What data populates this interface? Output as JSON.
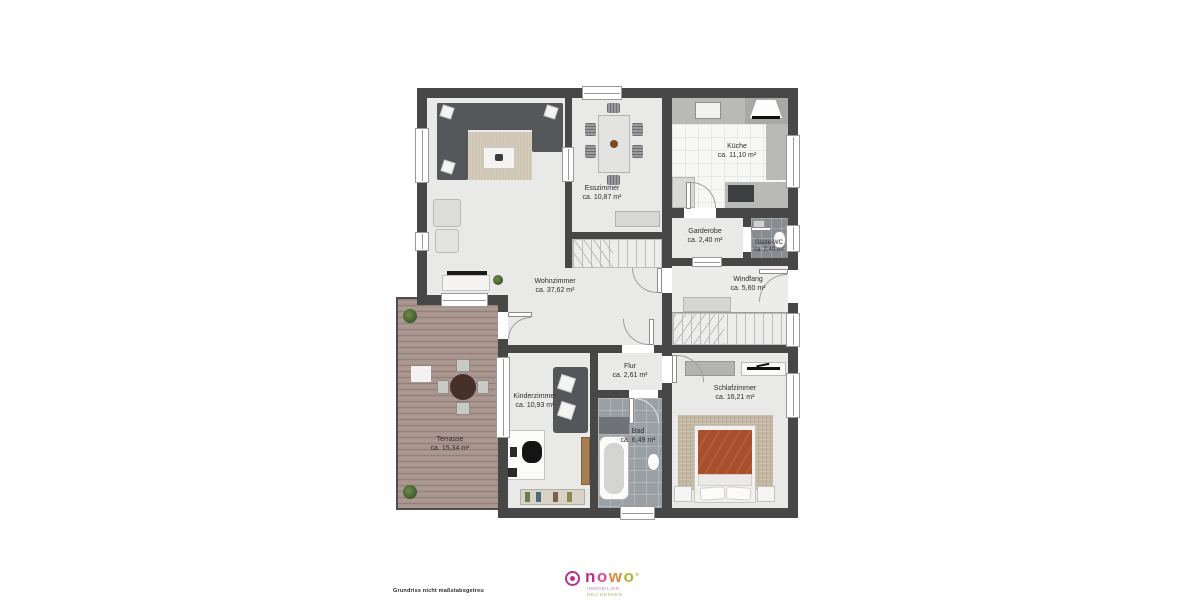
{
  "rooms": [
    {
      "id": "wohnzimmer",
      "name": "Wohnzimmer",
      "area": "ca. 37,62 m²"
    },
    {
      "id": "esszimmer",
      "name": "Esszimmer",
      "area": "ca. 10,87 m²"
    },
    {
      "id": "kueche",
      "name": "Küche",
      "area": "ca. 11,10 m²"
    },
    {
      "id": "garderobe",
      "name": "Garderobe",
      "area": "ca. 2,40 m²"
    },
    {
      "id": "gaeste_wc",
      "name": "Gäste-WC",
      "area": "ca. 2,40 m²"
    },
    {
      "id": "windfang",
      "name": "Windfang",
      "area": "ca. 5,60 m²"
    },
    {
      "id": "flur",
      "name": "Flur",
      "area": "ca. 2,61 m²"
    },
    {
      "id": "kinderzimmer",
      "name": "Kinderzimmer",
      "area": "ca. 10,93 m²"
    },
    {
      "id": "bad",
      "name": "Bad",
      "area": "ca. 6,49 m²"
    },
    {
      "id": "schlafzimmer",
      "name": "Schlafzimmer",
      "area": "ca. 16,21 m²"
    },
    {
      "id": "terrasse",
      "name": "Terrasse",
      "area": "ca. 15,34 m²"
    }
  ],
  "footer": {
    "disclaimer": "Grundriss nicht maßstabsgetreu",
    "brand_letters": [
      "n",
      "o",
      "w",
      "o"
    ],
    "brand_suffix": "°",
    "tagline_line1": "IMMOBILIEN",
    "tagline_line2": "NEU DENKEN"
  },
  "colors": {
    "wall": "#474747",
    "floor": "#e9e9e7",
    "terrace_wood": "#a8948c",
    "bed_duvet": "#a94f2c",
    "bath_tile": "#9aa0a4",
    "brand_magenta": "#b5338e",
    "brand_pink": "#d94f9a",
    "brand_orange": "#e08a3c",
    "brand_olive": "#b0b83a"
  }
}
